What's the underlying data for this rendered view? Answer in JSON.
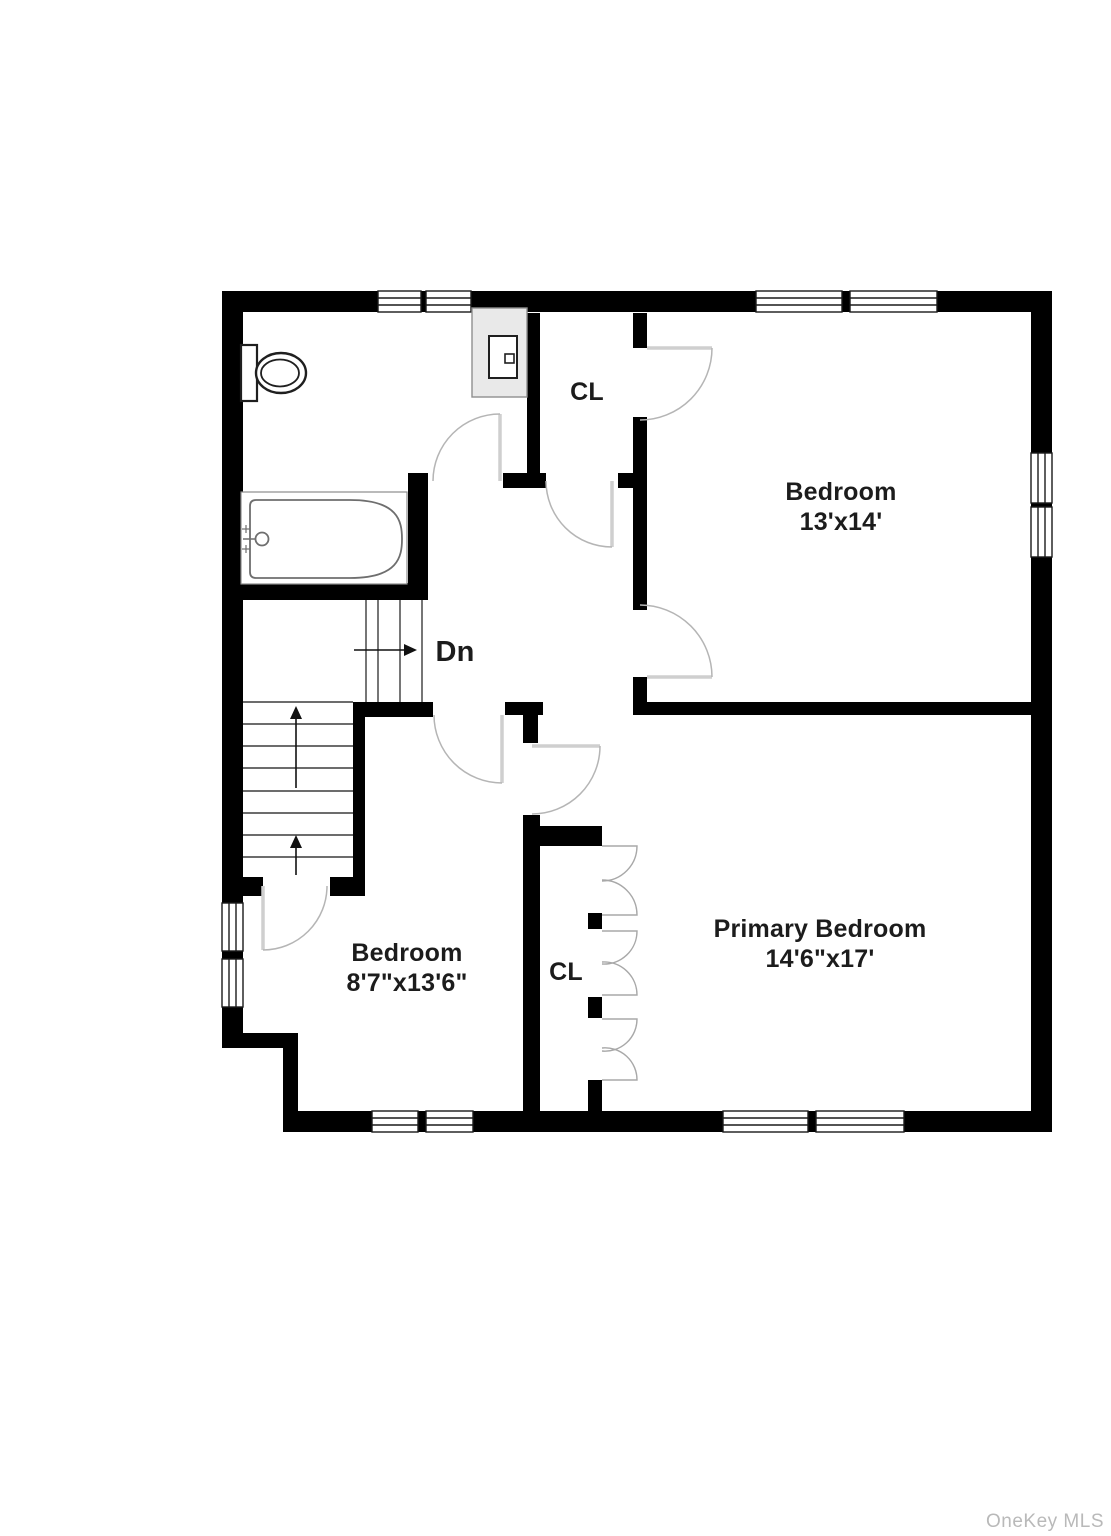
{
  "plan": {
    "labels": {
      "stairs_down": "Dn",
      "closet_top": "CL",
      "closet_bottom": "CL"
    },
    "rooms": {
      "bedroom_top_right": {
        "name": "Bedroom",
        "dims": "13'x14'"
      },
      "bedroom_bottom_left": {
        "name": "Bedroom",
        "dims": "8'7\"x13'6\""
      },
      "primary_bedroom": {
        "name": "Primary Bedroom",
        "dims": "14'6\"x17'"
      }
    },
    "fixtures": {
      "toilet": "toilet-icon",
      "bathtub": "bathtub-icon",
      "vanity_sink": "sink-icon"
    },
    "watermark": "OneKey MLS",
    "colors": {
      "wall": "#000000",
      "door_leaf": "#cfcfcf",
      "door_arc": "#b5b5b5",
      "bifold": "#a8a8a8",
      "stair": "#3c3c3c",
      "label": "#1c1c1c",
      "watermark": "#b9b9b9",
      "vanity_fill": "#e9e9e9"
    }
  }
}
